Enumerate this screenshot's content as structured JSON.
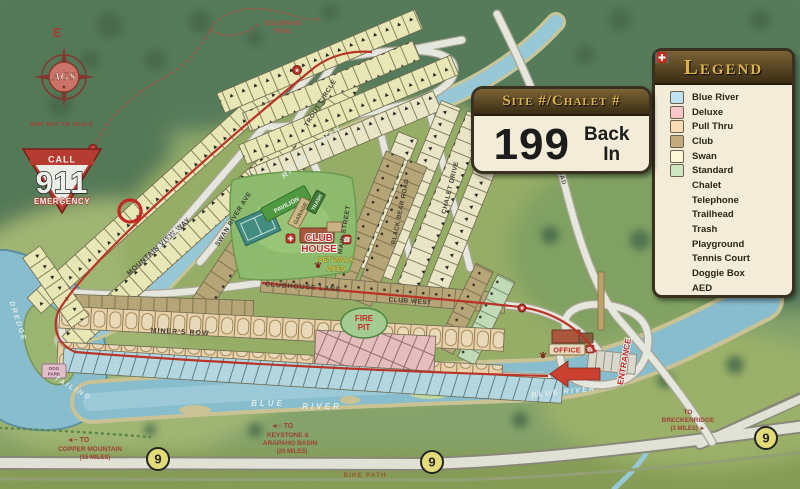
{
  "signs": {
    "site_sign": {
      "header": "Site #/Chalet #",
      "number": "199",
      "orientation_line1": "Back",
      "orientation_line2": "In"
    },
    "speed": {
      "line1": "SPEED",
      "line2": "LIMIT",
      "value": "10",
      "unit": "MPH"
    },
    "emergency": {
      "call": "CALL",
      "number": "911",
      "label": "EMERGENCY"
    },
    "compass": {
      "direction": "E",
      "logo": "AGS",
      "tagline": "MAP NOT TO SCALE"
    }
  },
  "icons": {
    "star": "★",
    "phone": "☎"
  },
  "legend": {
    "title": "Legend",
    "items": [
      {
        "label": "Blue River",
        "color": "#bfe3f2",
        "icon": "swatch"
      },
      {
        "label": "Deluxe",
        "color": "#f6c6ca",
        "icon": "swatch"
      },
      {
        "label": "Pull Thru",
        "color": "#fbdcb4",
        "icon": "swatch"
      },
      {
        "label": "Club",
        "color": "#c2ab7c",
        "icon": "swatch"
      },
      {
        "label": "Swan",
        "color": "#fcf8d8",
        "icon": "swatch"
      },
      {
        "label": "Standard",
        "color": "#cde7c3",
        "icon": "swatch"
      },
      {
        "label": "Chalet",
        "icon": "chalet-triangle"
      },
      {
        "label": "Telephone",
        "icon": "telephone"
      },
      {
        "label": "Trailhead",
        "icon": "trailhead-star"
      },
      {
        "label": "Trash",
        "icon": "trash-dumpster"
      },
      {
        "label": "Playground",
        "icon": "playground"
      },
      {
        "label": "Tennis Court",
        "icon": "tennis-court"
      },
      {
        "label": "Doggie Box",
        "icon": "paw"
      },
      {
        "label": "AED",
        "icon": "aed-cross"
      }
    ]
  },
  "roads": {
    "mountain_view_way": "MOUNTAIN VIEW WAY",
    "swan_river_ave": "SWAN RIVER AVE",
    "trout_circle": "TROUT CIRCLE",
    "main_street": "MAIN STREET",
    "black_bear_road": "BLACK BEAR ROAD",
    "chalet_drive": "CHALET DRIVE",
    "clubhouse_lane": "CLUBHOUSE LANE",
    "club_west": "CLUB WEST",
    "miners_row": "MINER'S ROW",
    "tiger_road": "TIGER ROAD",
    "colorado_trail_1": "COLORADO",
    "colorado_trail_2": "TRAIL",
    "bike_path": "BIKE PATH"
  },
  "rivers": {
    "swan": "SWAN",
    "river": "RIVER",
    "river2": "RIVER",
    "blue_l1": "BLUE",
    "blue_l2": "RIVER",
    "blue_right": "BLUE RIVER",
    "dredge": "DREDGE",
    "tailing": "TAILING"
  },
  "places": {
    "pavilion": "PAVILION",
    "garage": "GARAGE",
    "trash": "TRASH",
    "club_house_1": "CLUB",
    "club_house_2": "HOUSE",
    "pet_walk_1": "PET WALK",
    "pet_walk_2": "AREA",
    "fire_pit_1": "FIRE",
    "fire_pit_2": "PIT",
    "office": "OFFICE",
    "entrance": "ENTRANCE",
    "dog_park_1": "DOG",
    "dog_park_2": "PARK"
  },
  "directions": {
    "copper": {
      "l1": "◄– TO",
      "l2": "COPPER MOUNTAIN",
      "l3": "(15 MILES)"
    },
    "keystone": {
      "l1": "◄– TO",
      "l2": "KEYSTONE &",
      "l3": "ARAPAHO BASIN",
      "l4": "(20 MILES)"
    },
    "breckenridge": {
      "l1": "TO",
      "l2": "BRECKENRIDGE",
      "l3": "(3 MILES) ►"
    }
  },
  "highway": {
    "shield": "9"
  },
  "sites": {
    "highlighted": "199",
    "visible_ranges": [
      "149–248 Swan",
      "26–50 Club",
      "70–133 Chalets",
      "249–296 Club",
      "301–344 Pull Thru / Deluxe",
      "345–360 Blue River"
    ]
  }
}
